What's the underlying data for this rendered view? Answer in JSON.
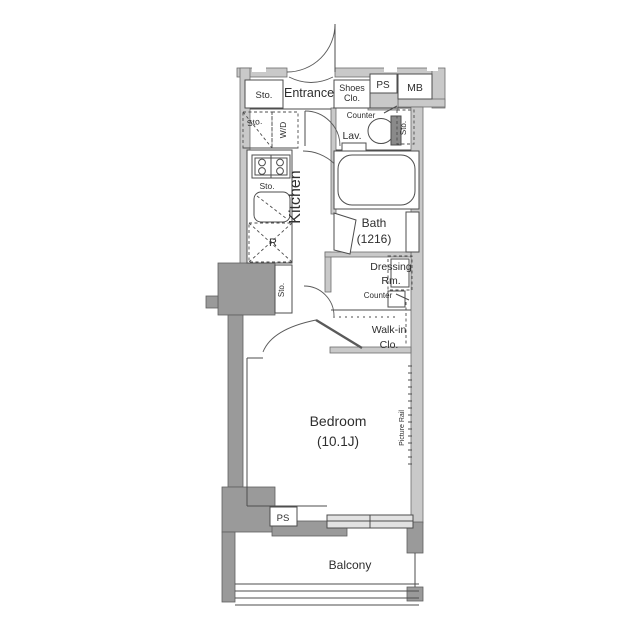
{
  "plan_title": "apartment-floor-plan",
  "colors": {
    "background": "#ffffff",
    "wall": "#c9c9c9",
    "pillar": "#9a9a9a",
    "line": "#4d4d4d",
    "text": "#2e2e2e",
    "window": "#e2e2e2"
  },
  "labels": {
    "sto": "Sto.",
    "entrance": "Entrance",
    "shoes": "Shoes",
    "clo": "Clo.",
    "ps": "PS",
    "mb": "MB",
    "wd": "W/D",
    "counter": "Counter",
    "lav": "Lav.",
    "kitchen": "Kitchen",
    "fridge": "R",
    "bath": "Bath",
    "bath_size": "(1216)",
    "dressing": "Dressing",
    "rm": "Rm.",
    "walk_in": "Walk-in",
    "bedroom": "Bedroom",
    "bedroom_size": "(10.1J)",
    "picture_rail": "Picture Rail",
    "balcony": "Balcony"
  }
}
